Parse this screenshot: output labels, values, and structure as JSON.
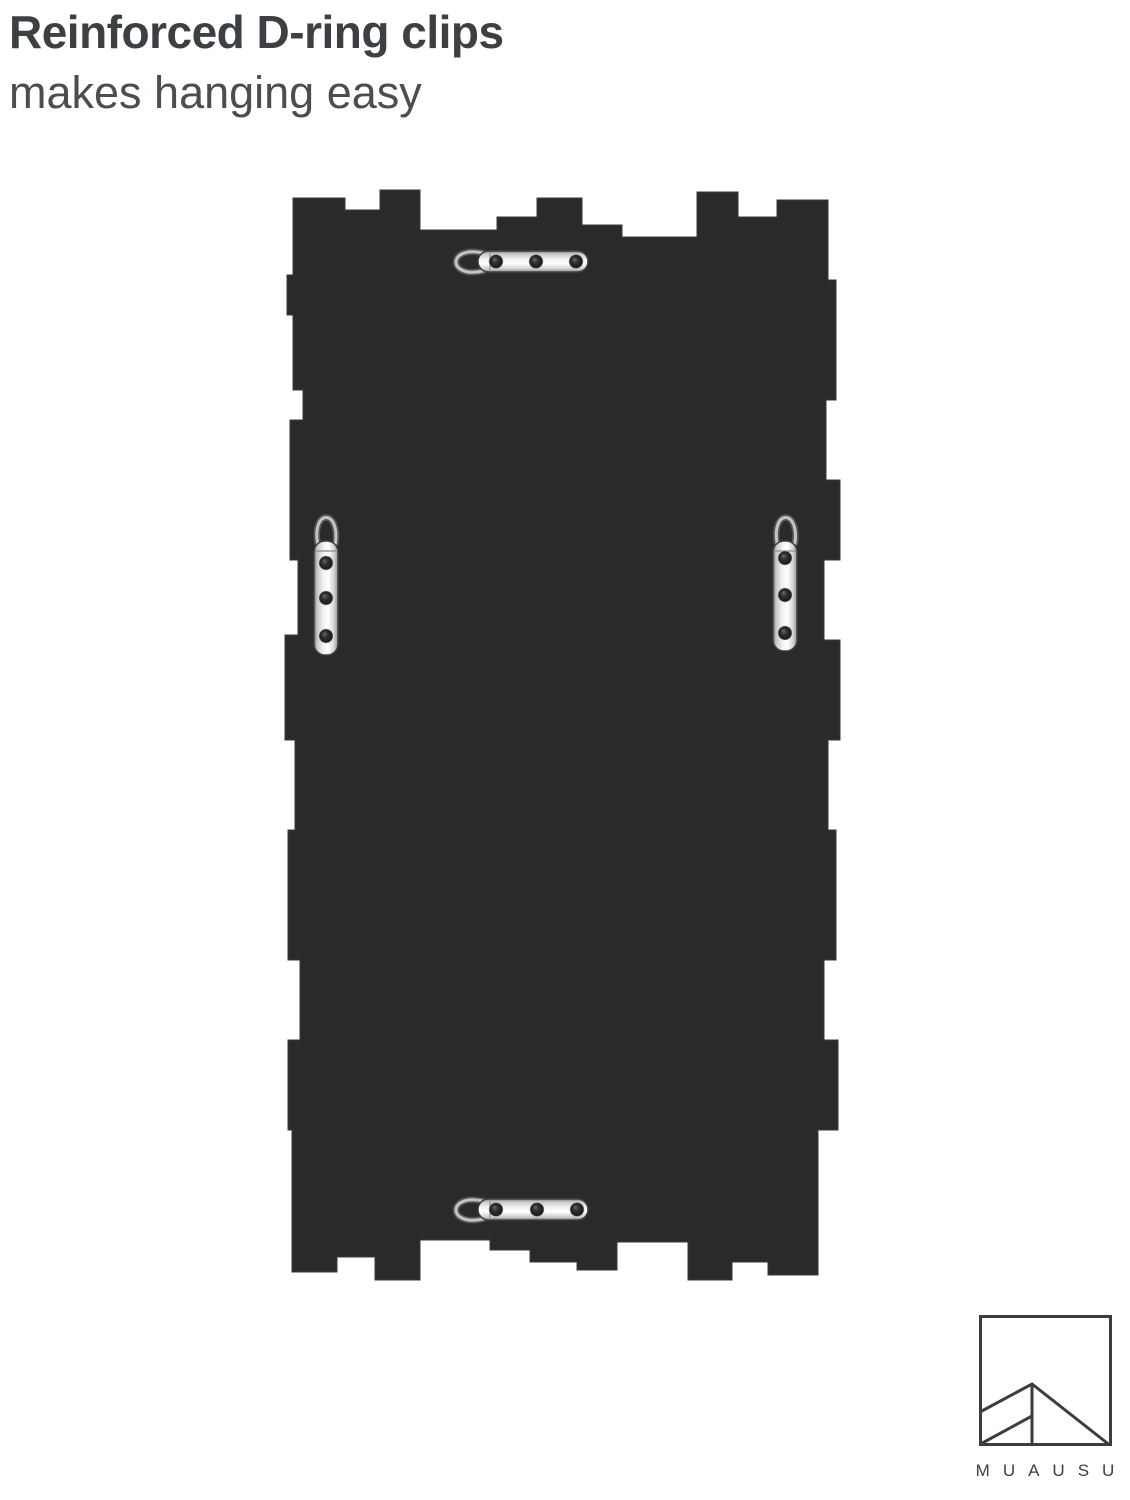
{
  "page": {
    "background": "#ffffff"
  },
  "heading": {
    "title": "Reinforced D-ring clips",
    "subtitle": "makes hanging easy"
  },
  "product": {
    "panel_color": "#2a2a2b",
    "clips": {
      "count": 4,
      "positions": [
        "top-center",
        "middle-left",
        "middle-right",
        "bottom-center"
      ],
      "screws_per_clip": 3
    },
    "metal_color": "#d9d9d9",
    "screw_color": "#1f1f1f"
  },
  "brand": {
    "name": "MUAUSU",
    "logo_color": "#3a3e42"
  }
}
